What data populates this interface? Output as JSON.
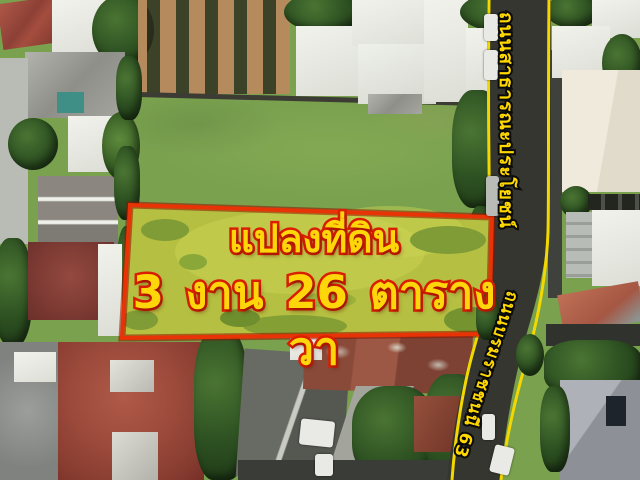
{
  "annotations": {
    "plot_label_line1": "แปลงที่ดิน",
    "plot_label_line2": "3 งาน 26 ตารางวา",
    "road_label_vertical": "ถนนสาธารณะประโยชน์",
    "road_label_diagonal": "ถนนบรมราชชนนี 63"
  },
  "colors": {
    "plot_outline_red": "#e73305",
    "headline_fill_yellow": "#ffd60a",
    "headline_stroke_red": "#dc1f00",
    "road_edge_line_yellow": "#f2d800",
    "road_label_yellow": "#ffd800",
    "road_label_outline_black": "#0d0d0d"
  }
}
